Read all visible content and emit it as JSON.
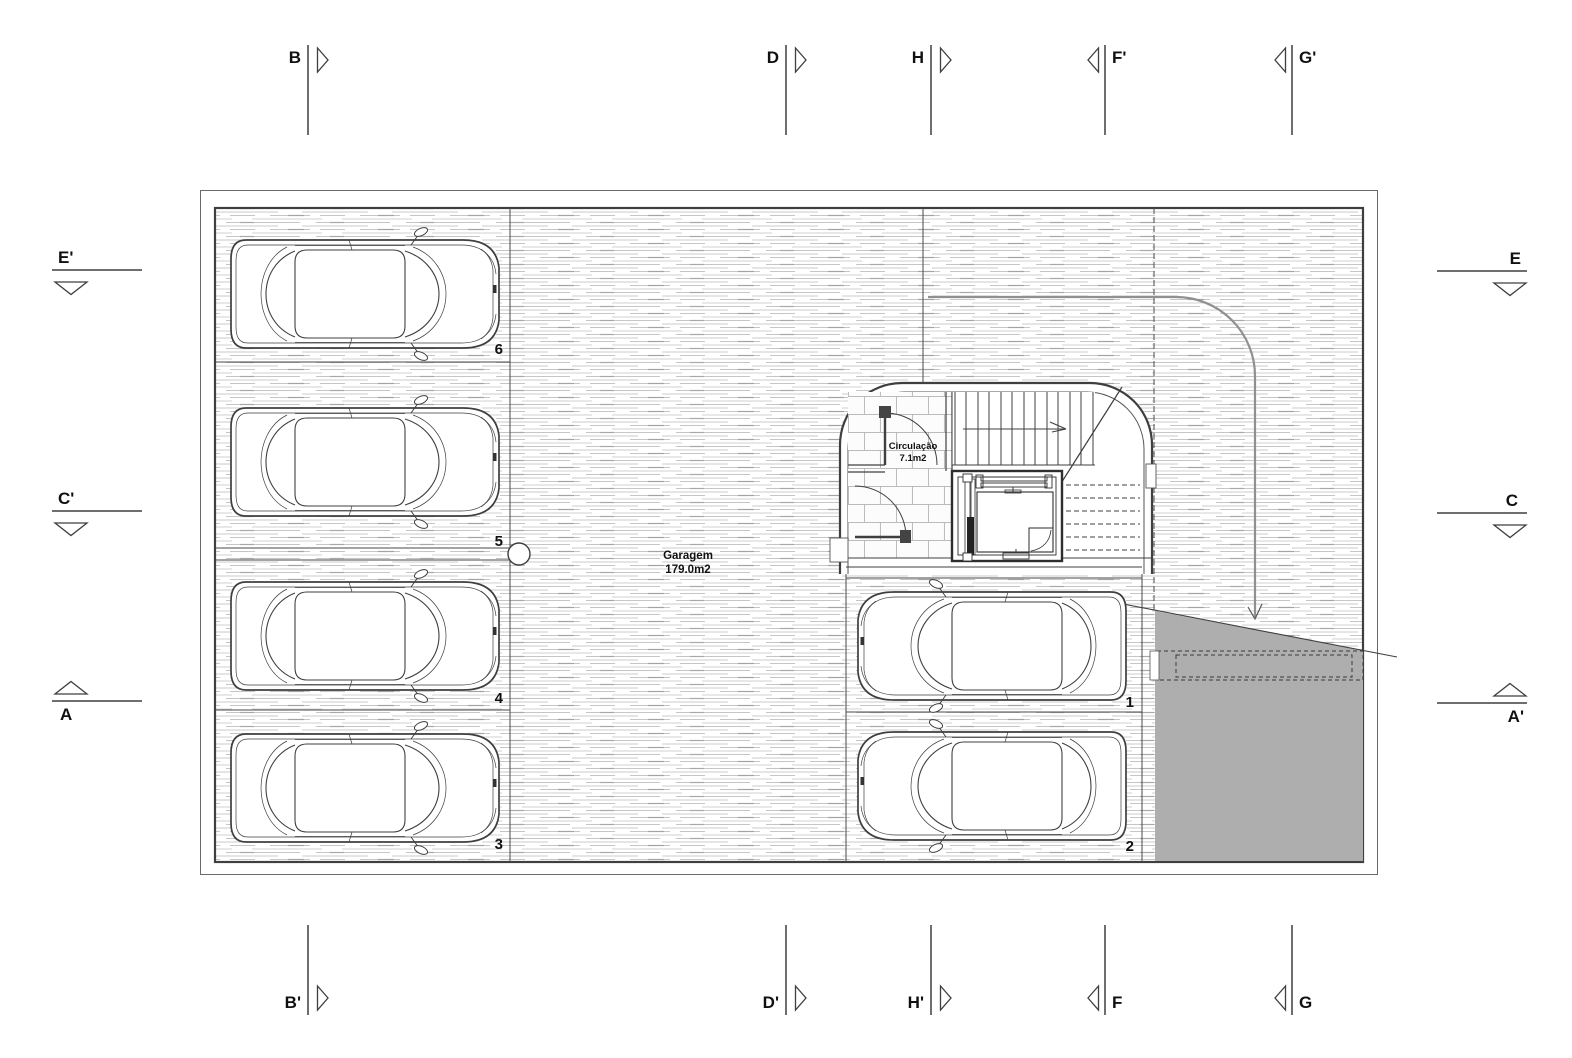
{
  "drawing": {
    "type": "garage floor plan",
    "colors": {
      "ramp_fill": "#aeaeae",
      "hatch_line": "#c9c9c9",
      "wall_line": "#3f3f3f",
      "marker_line": "#6e6e6e"
    }
  },
  "rooms": {
    "garage": {
      "name": "Garagem",
      "area": "179.0m2"
    },
    "circulation": {
      "name": "Circulação",
      "area": "7.1m2"
    }
  },
  "parking_spaces": [
    {
      "number": "1"
    },
    {
      "number": "2"
    },
    {
      "number": "3"
    },
    {
      "number": "4"
    },
    {
      "number": "5"
    },
    {
      "number": "6"
    }
  ],
  "section_markers": {
    "top": [
      {
        "label": "B"
      },
      {
        "label": "D"
      },
      {
        "label": "H"
      },
      {
        "label": "F'"
      },
      {
        "label": "G'"
      }
    ],
    "bottom": [
      {
        "label": "B'"
      },
      {
        "label": "D'"
      },
      {
        "label": "H'"
      },
      {
        "label": "F"
      },
      {
        "label": "G"
      }
    ],
    "left": [
      {
        "label": "E'"
      },
      {
        "label": "C'"
      },
      {
        "label": "A"
      }
    ],
    "right": [
      {
        "label": "E"
      },
      {
        "label": "C"
      },
      {
        "label": "A'"
      }
    ]
  }
}
